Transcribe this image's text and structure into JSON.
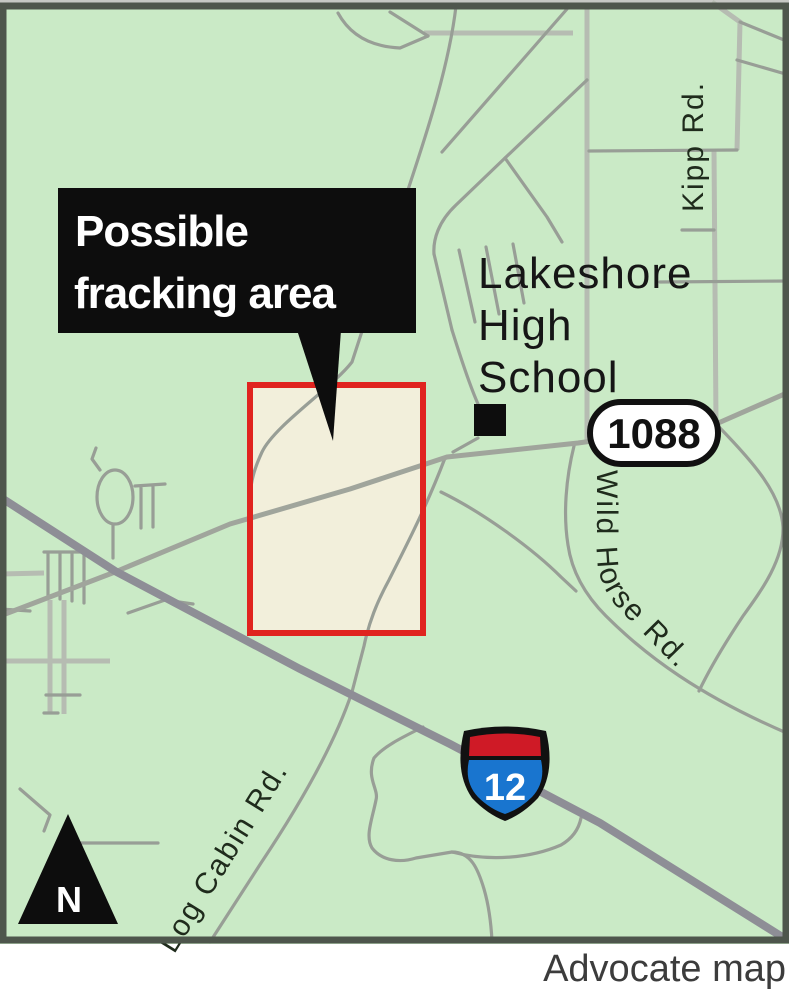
{
  "map": {
    "callout": {
      "line1": "Possible",
      "line2": "fracking area"
    },
    "school_label": {
      "lines": [
        "Lakeshore",
        "High",
        "School"
      ]
    },
    "road_labels": {
      "kipp": "Kipp Rd.",
      "wild_horse": "Wild Horse Rd.",
      "log_cabin": "Log Cabin Rd."
    },
    "route_shield": "1088",
    "interstate_shield": "12",
    "north_arrow": "N",
    "credit": "Advocate map",
    "colors": {
      "land": "#caeac6",
      "fracking_fill": "#f2efdb",
      "fracking_border": "#e0241f",
      "road_gray": "#9aa098",
      "interstate_blue": "#1975cf",
      "interstate_red": "#cf1a26",
      "frame": "#4e564c",
      "callout_bg": "#0d0d0d"
    }
  }
}
